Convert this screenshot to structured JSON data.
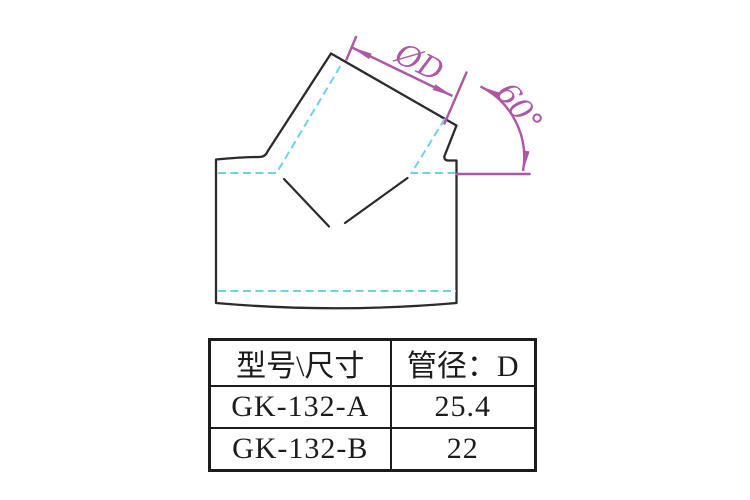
{
  "diagram": {
    "labels": {
      "diameter": "ØD",
      "angle": "60°"
    },
    "colors": {
      "outline": "#2b2b2b",
      "centerline": "#6ed1e4",
      "dimension": "#ae57a4"
    }
  },
  "table": {
    "headers": [
      "型号\\尺寸",
      "管径：D"
    ],
    "rows": [
      {
        "model": "GK-132-A",
        "diameter": "25.4"
      },
      {
        "model": "GK-132-B",
        "diameter": "22"
      }
    ]
  }
}
